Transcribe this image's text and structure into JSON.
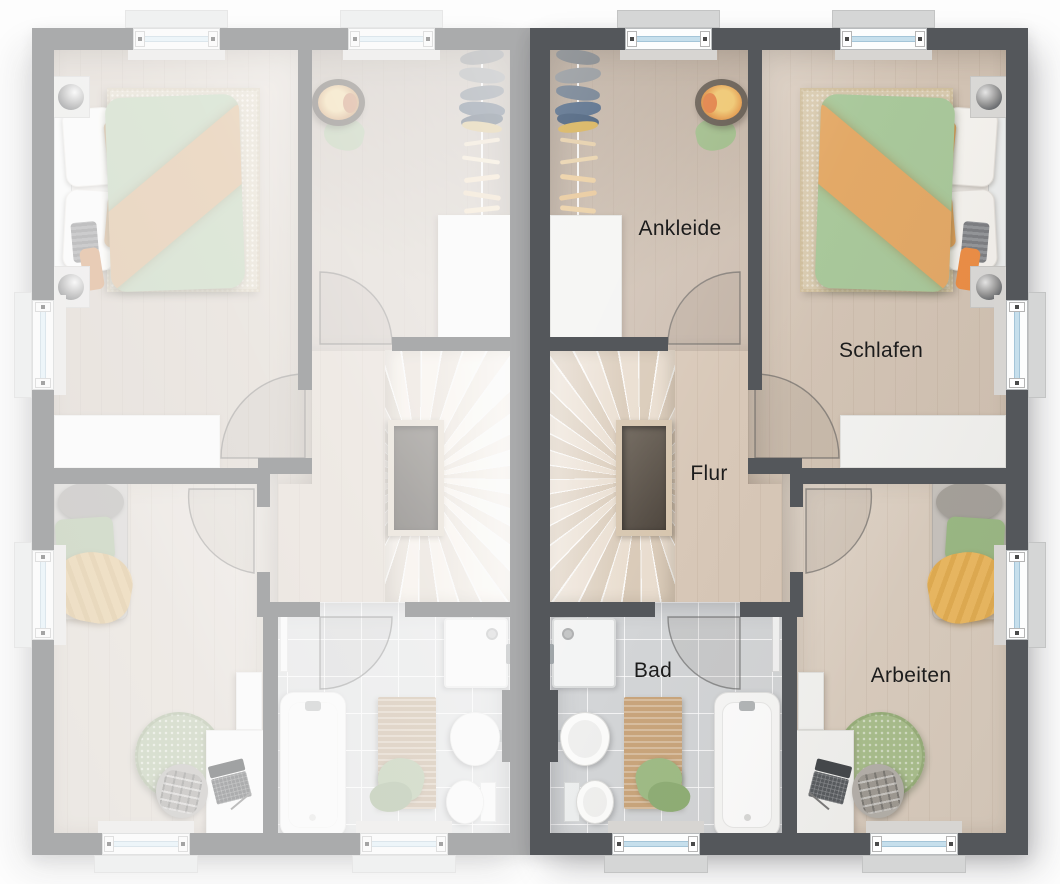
{
  "floorplan": {
    "description": "Mirrored duplex upper-floor plan, right unit highlighted, left unit faded",
    "rooms": {
      "ankleide": {
        "label": "Ankleide"
      },
      "schlafen": {
        "label": "Schlafen"
      },
      "flur": {
        "label": "Flur"
      },
      "bad": {
        "label": "Bad"
      },
      "arbeiten": {
        "label": "Arbeiten"
      }
    },
    "palette": {
      "wall_highlighted": "#54575b",
      "wall_faded": "#a8a8a8",
      "floor_wood": "#d6c7b8",
      "bath_tile": "#d3d5d7",
      "accent_green": "#a9c89b",
      "accent_orange": "#e3a967",
      "accent_yellow": "#eebb62",
      "window_glass": "#c6dfec"
    }
  }
}
